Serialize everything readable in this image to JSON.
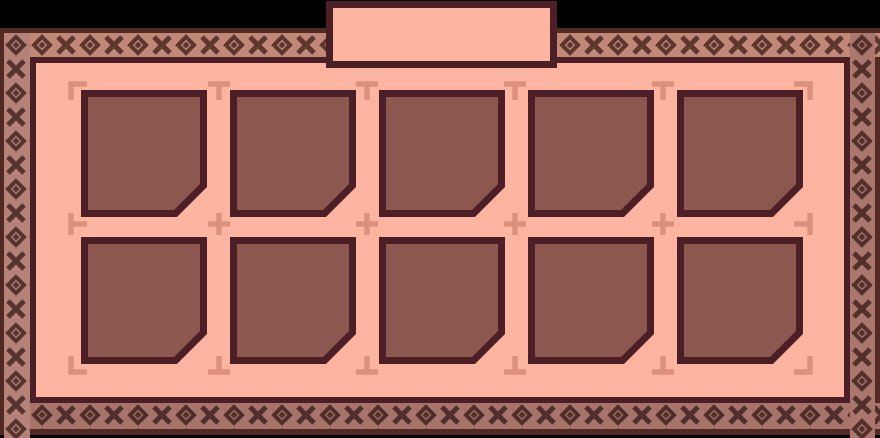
{
  "window": {
    "title": "",
    "width_px": 880,
    "height_px": 438
  },
  "tab": {
    "label": ""
  },
  "colors": {
    "background": "#000000",
    "frame_edge": "#522a22",
    "panel_fill": "#fdb4a0",
    "panel_border": "#4b1f25",
    "slot_fill": "#8b574f",
    "slot_border": "#4b1f25",
    "guide_mark": "#dc917d",
    "pattern": {
      "top_bg": "#c18878",
      "top_fg": "#5d362e",
      "left_bg": "#b5827a",
      "left_fg": "#56332c",
      "right_bg": "#aa776e",
      "right_fg": "#53302a",
      "bottom_bg": "#a6746b",
      "bottom_fg": "#502e29"
    }
  },
  "inventory": {
    "rows": 2,
    "columns": 5,
    "slot_count": 10,
    "slots": [
      {
        "id": 1,
        "state": "empty"
      },
      {
        "id": 2,
        "state": "empty"
      },
      {
        "id": 3,
        "state": "empty"
      },
      {
        "id": 4,
        "state": "empty"
      },
      {
        "id": 5,
        "state": "empty"
      },
      {
        "id": 6,
        "state": "empty"
      },
      {
        "id": 7,
        "state": "empty"
      },
      {
        "id": 8,
        "state": "empty"
      },
      {
        "id": 9,
        "state": "empty"
      },
      {
        "id": 10,
        "state": "empty"
      }
    ]
  },
  "guide_marks": {
    "grid": [
      [
        "corner-top-left",
        "tee-down",
        "tee-down",
        "tee-down",
        "tee-down",
        "corner-top-right"
      ],
      [
        "tee-right",
        "cross",
        "cross",
        "cross",
        "cross",
        "tee-left"
      ],
      [
        "corner-bottom-left",
        "tee-up",
        "tee-up",
        "tee-up",
        "tee-up",
        "corner-bottom-right"
      ]
    ]
  }
}
